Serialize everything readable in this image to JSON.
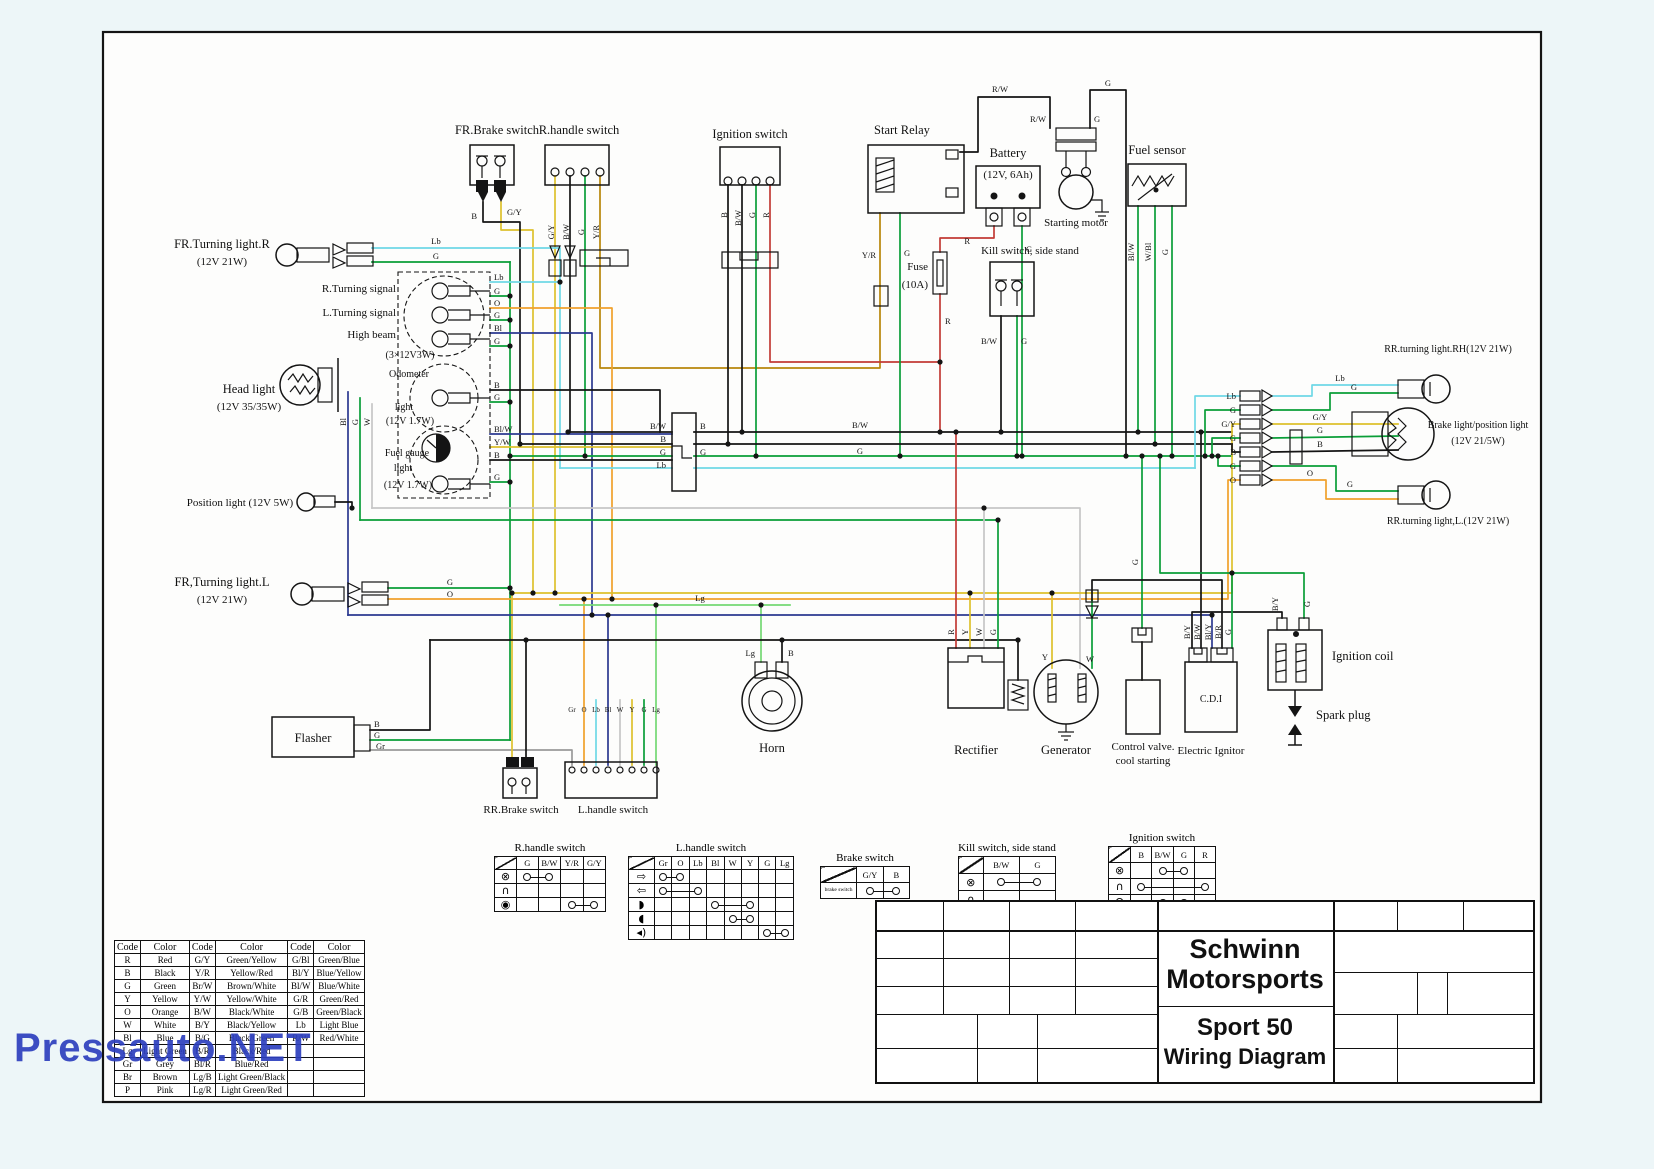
{
  "watermark": "Pressauto.NET",
  "colors": {
    "page_bg": "#edf6f8",
    "paper": "#fdfdfc",
    "ink": "#141414",
    "watermark_blue": "#2d3fbe",
    "wire_palette": {
      "R": "#c23b36",
      "B": "#141414",
      "G": "#0a9e38",
      "Y": "#ddc12d",
      "O": "#f0a12c",
      "W": "#c6c6c6",
      "Bl": "#2b3990",
      "Lg": "#74d874",
      "Lb": "#6fd8e6",
      "Gr": "#9a9a9a",
      "Br": "#8b5a2b",
      "P": "#e78fb3"
    }
  },
  "labels": {
    "fr_brake_switch": "FR.Brake switch",
    "r_handle_switch": "R.handle switch",
    "ignition_switch": "Ignition switch",
    "start_relay": "Start Relay",
    "battery": "Battery",
    "battery_rating": "(12V, 6Ah)",
    "starting_motor": "Starting motor",
    "kill_switch": "Kill switch, side stand",
    "fuel_sensor": "Fuel sensor",
    "fuse": "Fuse",
    "fuse_rating": "(10A)",
    "fr_turn_r_1": "FR.Turning light.R",
    "fr_turn_r_2": "(12V 21W)",
    "r_turn_signal": "R.Turning signal",
    "l_turn_signal": "L.Turning signal",
    "high_beam": "High beam",
    "cluster_rating": "(3×12V3W)",
    "odometer_1": "Odometer",
    "odometer_2": "light",
    "odometer_rating": "(12V 1.7W)",
    "head_light_1": "Head light",
    "head_light_2": "(12V 35/35W)",
    "fuel_gauge_1": "Fuel gauge",
    "fuel_gauge_2": "light",
    "fuel_gauge_rating": "(12V 1.7W)",
    "position_light": "Position light (12V 5W)",
    "fr_turn_l_1": "FR,Turning light.L",
    "fr_turn_l_2": "(12V 21W)",
    "flasher": "Flasher",
    "rr_brake_switch": "RR.Brake switch",
    "l_handle_switch": "L.handle switch",
    "horn": "Horn",
    "rectifier": "Rectifier",
    "generator": "Generator",
    "control_valve_1": "Control valve.",
    "control_valve_2": "cool starting",
    "electric_ignitor": "Electric Ignitor",
    "cdi": "C.D.I",
    "ignition_coil": "Ignition coil",
    "spark_plug": "Spark plug",
    "rr_turn_rh": "RR.turning light.RH(12V 21W)",
    "brake_light_1": "Brake light/position light",
    "brake_light_2": "(12V 21/5W)",
    "rr_turn_l": "RR.turning light,L.(12V 21W)"
  },
  "tags": {
    "lb": "Lb",
    "g": "G",
    "gy": "G/Y",
    "b": "B",
    "o": "O",
    "bl": "Bl",
    "w": "W",
    "y": "Y",
    "r": "R",
    "lg": "Lg",
    "gr": "Gr",
    "bw": "B/W",
    "yw": "Y/W",
    "yr": "Y/R",
    "rw": "R/W",
    "blw": "Bl/W",
    "wbl": "W/Bl",
    "by": "B/Y",
    "bly": "Bl/Y",
    "br": "B/R",
    "lh_pins": [
      "Gr",
      "O",
      "Lb",
      "Bl",
      "W",
      "Y",
      "G",
      "Lg"
    ]
  },
  "title_block": {
    "brand_l1": "Schwinn",
    "brand_l2": "Motorsports",
    "model": "Sport 50",
    "doc": "Wiring Diagram"
  },
  "color_table": {
    "headers": [
      "Code",
      "Color",
      "Code",
      "Color",
      "Code",
      "Color"
    ],
    "rows": [
      [
        "R",
        "Red",
        "G/Y",
        "Green/Yellow",
        "G/Bl",
        "Green/Blue"
      ],
      [
        "B",
        "Black",
        "Y/R",
        "Yellow/Red",
        "Bl/Y",
        "Blue/Yellow"
      ],
      [
        "G",
        "Green",
        "Br/W",
        "Brown/White",
        "Bl/W",
        "Blue/White"
      ],
      [
        "Y",
        "Yellow",
        "Y/W",
        "Yellow/White",
        "G/R",
        "Green/Red"
      ],
      [
        "O",
        "Orange",
        "B/W",
        "Black/White",
        "G/B",
        "Green/Black"
      ],
      [
        "W",
        "White",
        "B/Y",
        "Black/Yellow",
        "Lb",
        "Light Blue"
      ],
      [
        "Bl",
        "Blue",
        "B/G",
        "Black/Green",
        "R/W",
        "Red/White"
      ],
      [
        "Lg",
        "Light Green",
        "B/R",
        "Black/Red",
        "",
        ""
      ],
      [
        "Gr",
        "Grey",
        "Bl/R",
        "Blue/Red",
        "",
        ""
      ],
      [
        "Br",
        "Brown",
        "Lg/B",
        "Light Green/Black",
        "",
        ""
      ],
      [
        "P",
        "Pink",
        "Lg/R",
        "Light Green/Red",
        "",
        ""
      ]
    ]
  },
  "switch_tables": [
    {
      "name": "r-handle-switch-table",
      "title": "R.handle switch",
      "iconw": 22,
      "colw": 22,
      "rowh": 12,
      "columns": [
        "G",
        "B/W",
        "Y/R",
        "G/Y"
      ],
      "rows": [
        {
          "icon": "⊗",
          "icon_name": "start-icon",
          "link": [
            0,
            1
          ]
        },
        {
          "icon": "∩",
          "icon_name": "off-icon",
          "link": null
        },
        {
          "icon": "◉",
          "icon_name": "starter-button-icon",
          "link": [
            2,
            3
          ]
        }
      ]
    },
    {
      "name": "l-handle-switch-table",
      "title": "L.handle switch",
      "iconw": 26,
      "colw": 17,
      "rowh": 12,
      "columns": [
        "Gr",
        "O",
        "Lb",
        "Bl",
        "W",
        "Y",
        "G",
        "Lg"
      ],
      "rows": [
        {
          "icon": "⇨",
          "icon_name": "right-turn-icon",
          "link": [
            0,
            1
          ]
        },
        {
          "icon": "⇦",
          "icon_name": "left-turn-icon",
          "link": [
            0,
            2
          ]
        },
        {
          "icon": "◗",
          "icon_name": "high-beam-icon",
          "link": [
            3,
            5
          ]
        },
        {
          "icon": "◖",
          "icon_name": "low-beam-icon",
          "link": [
            4,
            5
          ]
        },
        {
          "icon": "◂)",
          "icon_name": "horn-icon",
          "link": [
            6,
            7
          ]
        }
      ]
    },
    {
      "name": "brake-switch-table",
      "title": "Brake switch",
      "iconw": 36,
      "colw": 26,
      "rowh": 15,
      "columns": [
        "G/Y",
        "B"
      ],
      "rows": [
        {
          "icon": "brake switch",
          "icon_name": "brake-switch-label",
          "tiny": true,
          "link": [
            0,
            1
          ]
        }
      ]
    },
    {
      "name": "kill-switch-table",
      "title": "Kill switch, side stand",
      "iconw": 24,
      "colw": 36,
      "rowh": 16,
      "columns": [
        "B/W",
        "G"
      ],
      "rows": [
        {
          "icon": "⊗",
          "icon_name": "run-icon",
          "link": [
            0,
            1
          ]
        },
        {
          "icon": "∩",
          "icon_name": "off-icon",
          "link": null
        }
      ]
    },
    {
      "name": "ignition-switch-table",
      "title": "Ignition switch",
      "iconw": 22,
      "colw": 21,
      "rowh": 15,
      "columns": [
        "B",
        "B/W",
        "G",
        "R"
      ],
      "rows": [
        {
          "icon": "⊗",
          "icon_name": "on-icon",
          "link": [
            1,
            2
          ]
        },
        {
          "icon": "∩",
          "icon_name": "off-icon",
          "link": [
            0,
            3
          ]
        },
        {
          "icon": "Ω",
          "icon_name": "lock-icon",
          "link": [
            1,
            2
          ]
        }
      ]
    }
  ]
}
